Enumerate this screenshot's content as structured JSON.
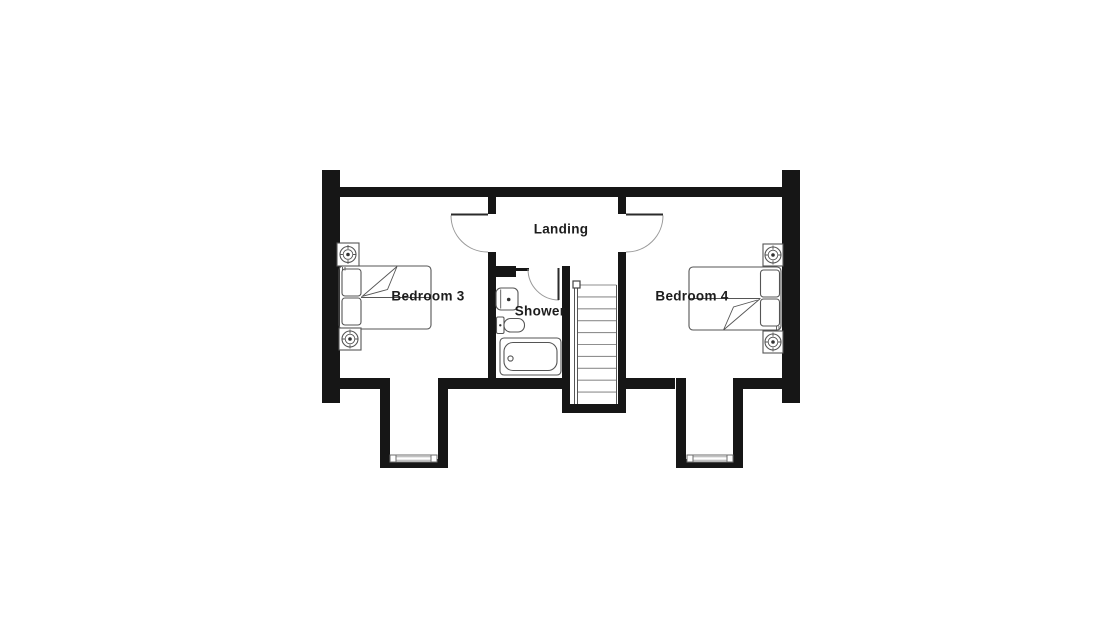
{
  "floorplan": {
    "background_color": "#ffffff",
    "wall_color": "#161616",
    "furniture_line_color": "#555555",
    "door_arc_color": "#999999",
    "label_color": "#1c1c1c",
    "rooms": [
      {
        "id": "landing",
        "label": "Landing"
      },
      {
        "id": "bedroom-3",
        "label": "Bedroom 3",
        "furniture": [
          "double-bed",
          "bedside-table",
          "bedside-table"
        ]
      },
      {
        "id": "bedroom-4",
        "label": "Bedroom 4",
        "furniture": [
          "double-bed",
          "bedside-table",
          "bedside-table"
        ]
      },
      {
        "id": "shower-room",
        "label": "Shower",
        "fixtures": [
          "basin",
          "toilet",
          "bath"
        ]
      }
    ],
    "features": [
      "staircase",
      "dormer-window-left",
      "dormer-window-right",
      "door-bedroom-3",
      "door-bedroom-4",
      "door-shower-room"
    ]
  }
}
